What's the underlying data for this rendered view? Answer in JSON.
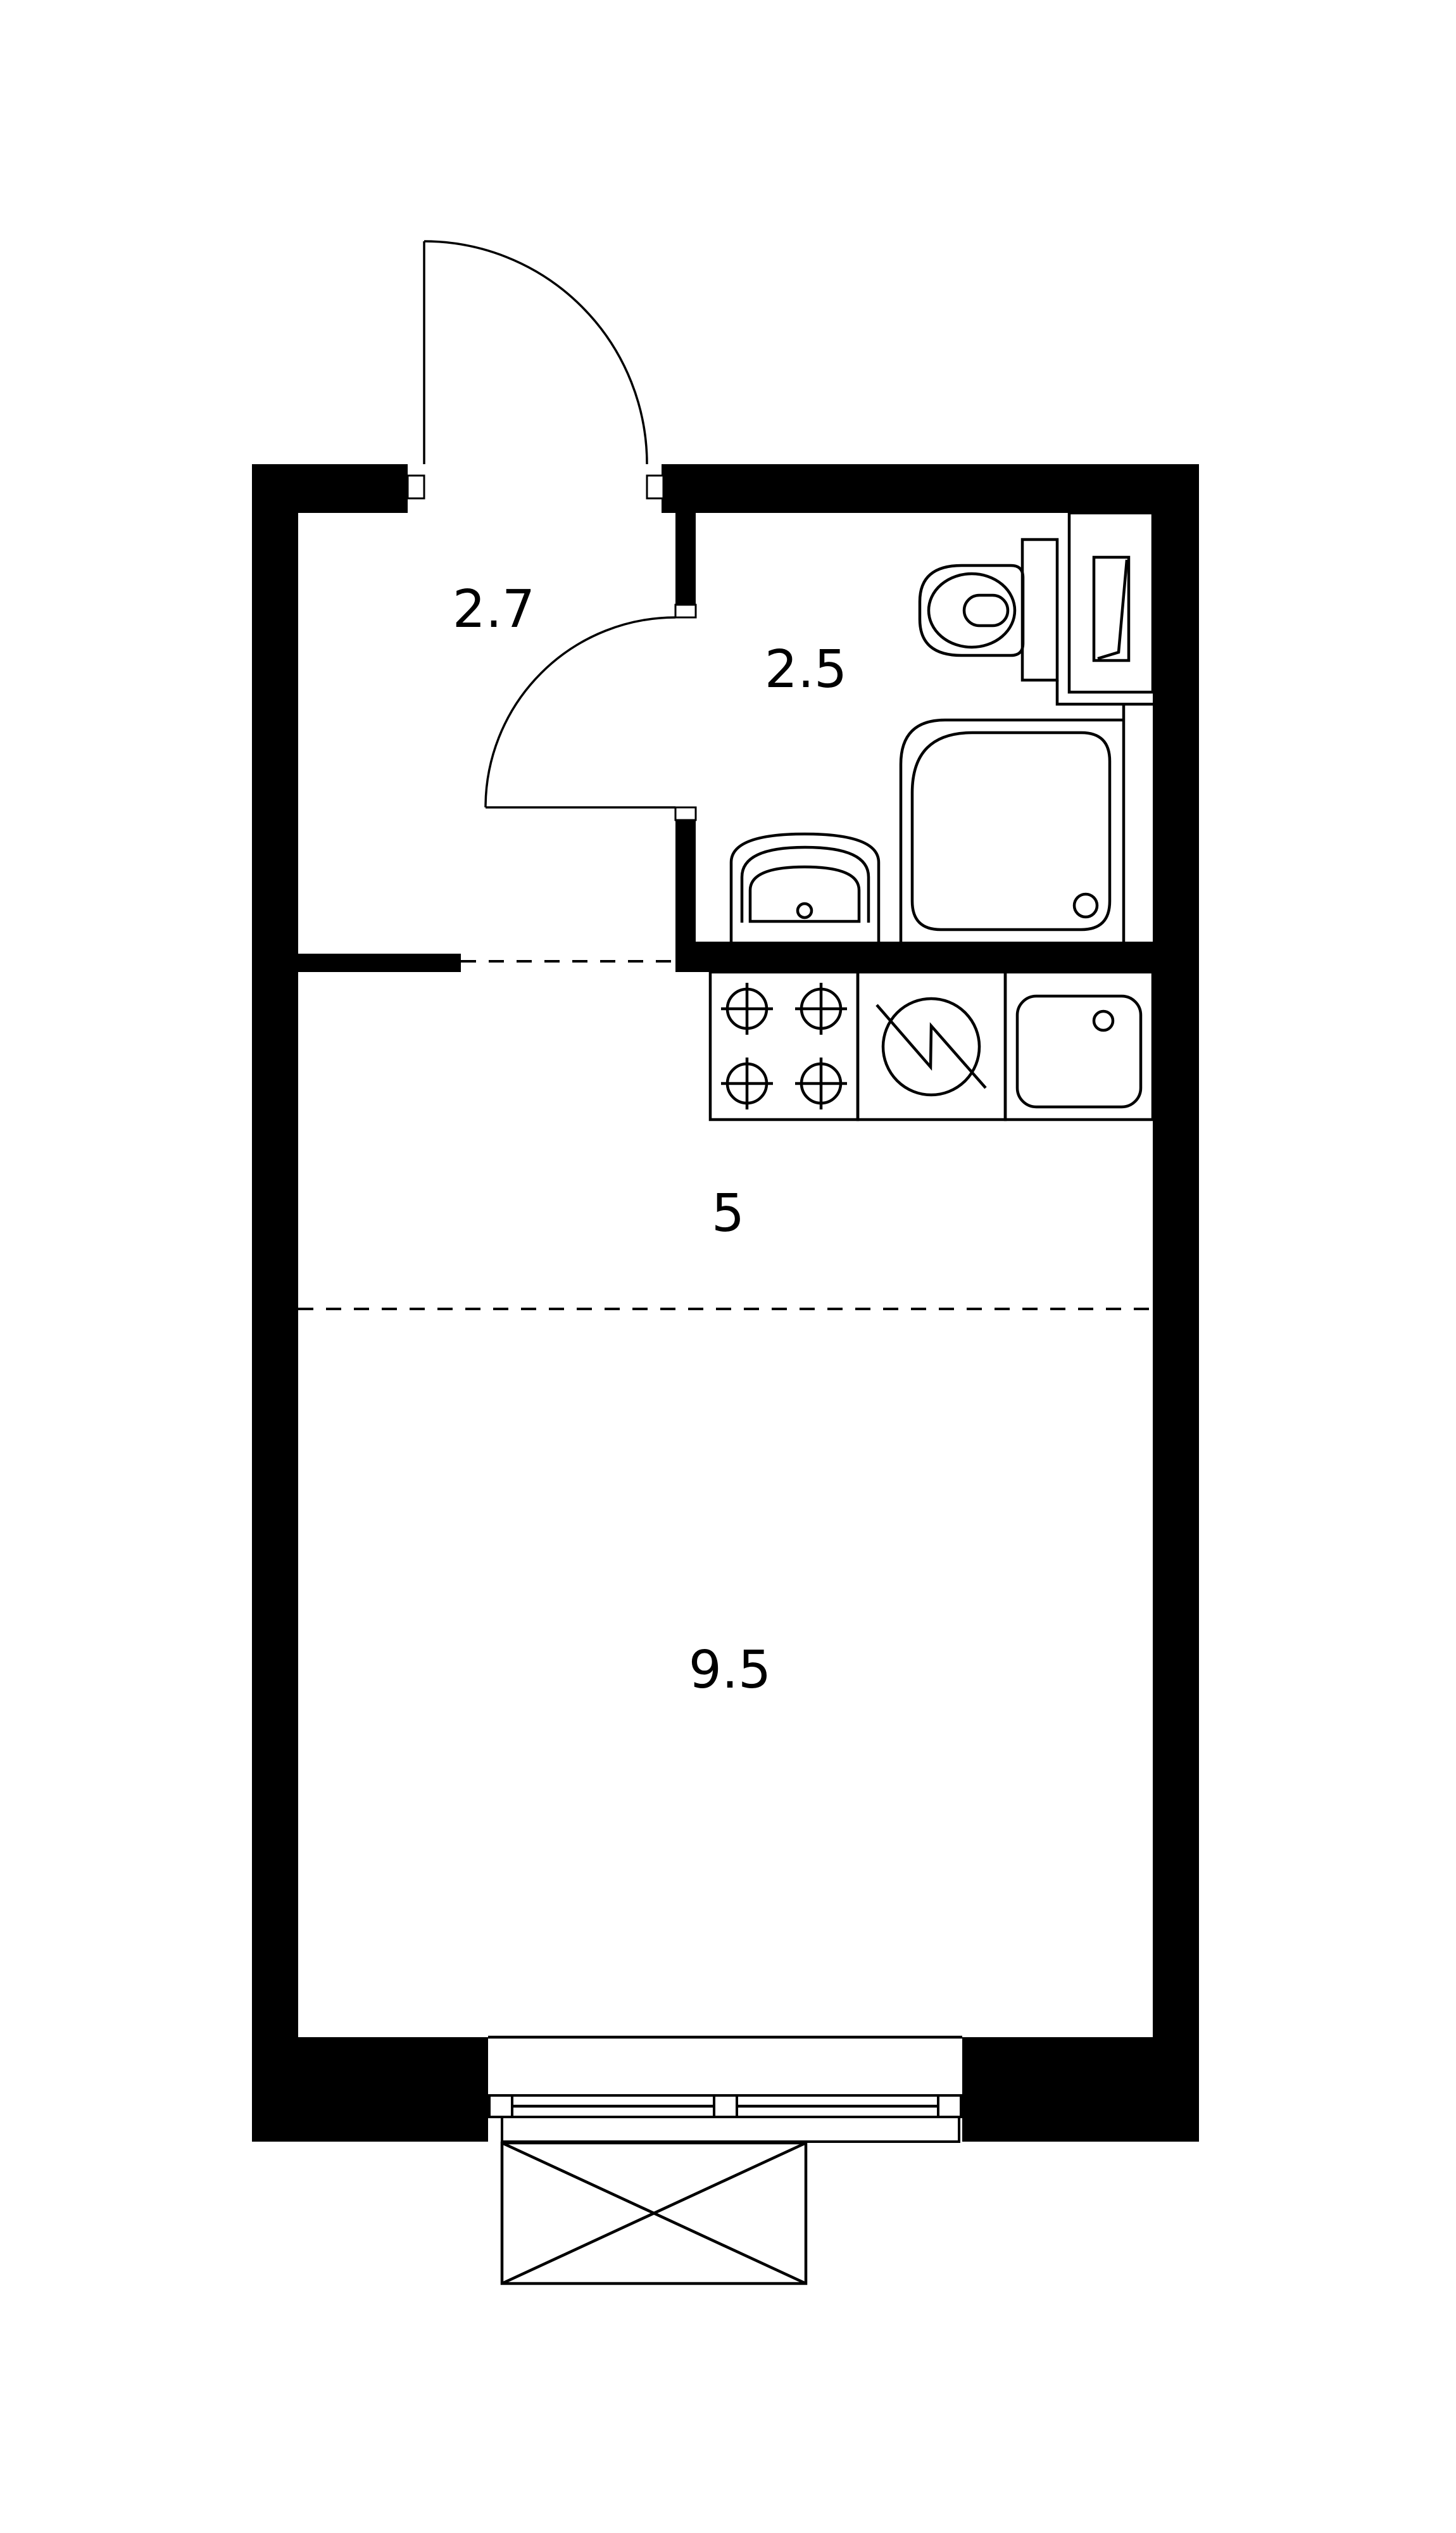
{
  "plan": {
    "type": "studio-apartment-floor-plan",
    "rooms": {
      "hallway": {
        "area_label": "2.7"
      },
      "bathroom": {
        "area_label": "2.5"
      },
      "kitchen": {
        "area_label": "5"
      },
      "living_room": {
        "area_label": "9.5"
      }
    },
    "icons": [
      "entry-door-icon",
      "bathroom-door-icon",
      "toilet-icon",
      "toilet-tank-icon",
      "utility-cabinet-icon",
      "shower-tray-icon",
      "washbasin-icon",
      "stove-burners-icon",
      "kitchen-sink-icon",
      "washing-machine-icon",
      "window-icon",
      "balcony-icon"
    ],
    "colors": {
      "background": "#ffffff",
      "walls": "#000000",
      "lines": "#000000",
      "text": "#000000"
    }
  }
}
